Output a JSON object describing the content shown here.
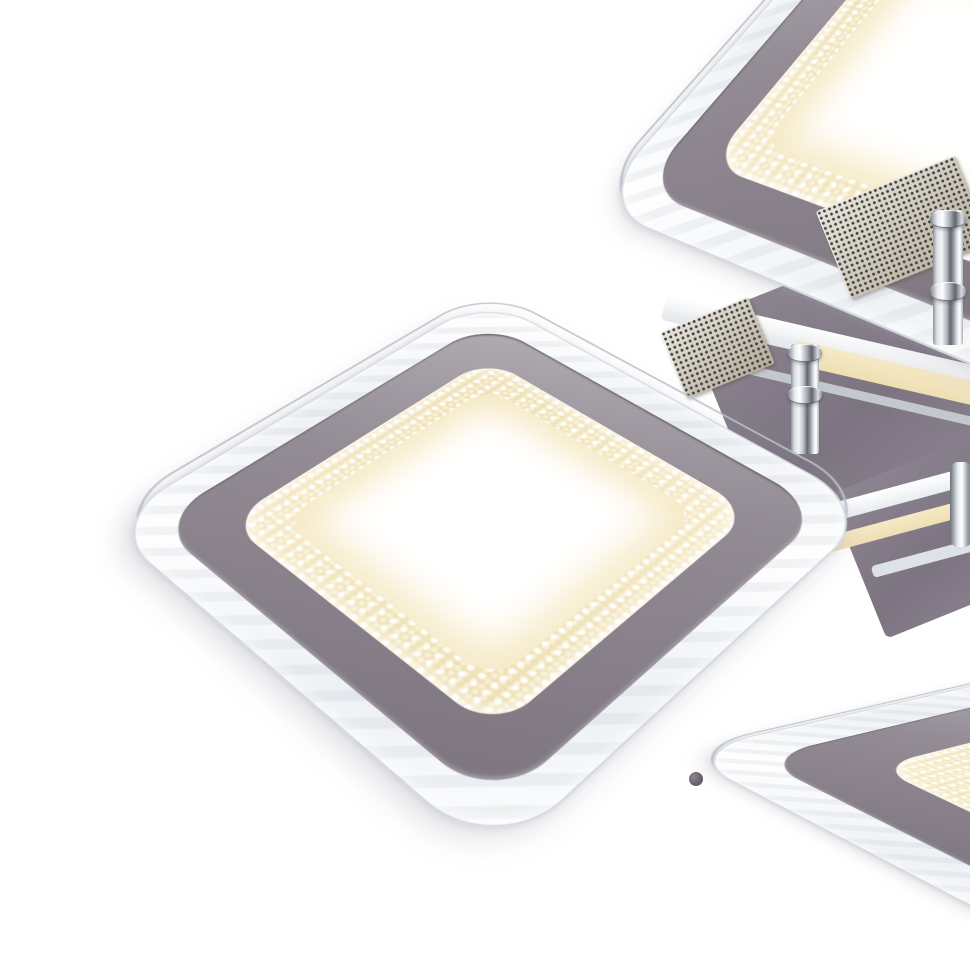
{
  "scene": {
    "type": "product-photo",
    "subject": "Modern chrome LED flush-mount ceiling light with three square edge-lit panels, shown lit with warm-white LED rings on a white background",
    "background": "#ffffff",
    "panels": [
      {
        "id": "front",
        "position": "center-left",
        "state": "lit",
        "parts": [
          "clear acrylic rim",
          "gray metal frame",
          "warm LED ring",
          "white diffuser center"
        ]
      },
      {
        "id": "top-right",
        "position": "upper-right, partially out of frame",
        "state": "lit",
        "parts": [
          "clear acrylic rim",
          "gray metal frame",
          "warm LED ring",
          "white diffuser center"
        ]
      },
      {
        "id": "bottom-right",
        "position": "lower-right, partially out of frame",
        "state": "lit",
        "parts": [
          "clear acrylic rim",
          "gray metal frame",
          "warm LED ring",
          "white diffuser center"
        ]
      }
    ],
    "hardware": {
      "backplates": 2,
      "perforated_plates": 2,
      "chrome_rods": 2,
      "description": "Dark gray mounting plates with perforated ventilation panels and polished chrome support rods connecting the panels"
    },
    "colors": {
      "background": "#ffffff",
      "acrylic_edge": "#eef1f5",
      "acrylic_highlight": "#ffffff",
      "frame_gray_light": "#b2acb3",
      "frame_gray": "#948d96",
      "frame_gray_dark": "#7f7781",
      "led_warm": "#eedfb2",
      "led_warm_bright": "#f6e9c6",
      "led_glow": "#f6e9c4",
      "panel_white": "#ffffff",
      "plate_dark": "#8d8591",
      "plate_dark_deep": "#7c7480",
      "perforated_base": "#cdc6b5",
      "perforated_hole": "#44403a",
      "chrome_light": "#f4f6f8",
      "chrome_mid": "#aab0b6",
      "chrome_dark": "#62686f"
    }
  }
}
